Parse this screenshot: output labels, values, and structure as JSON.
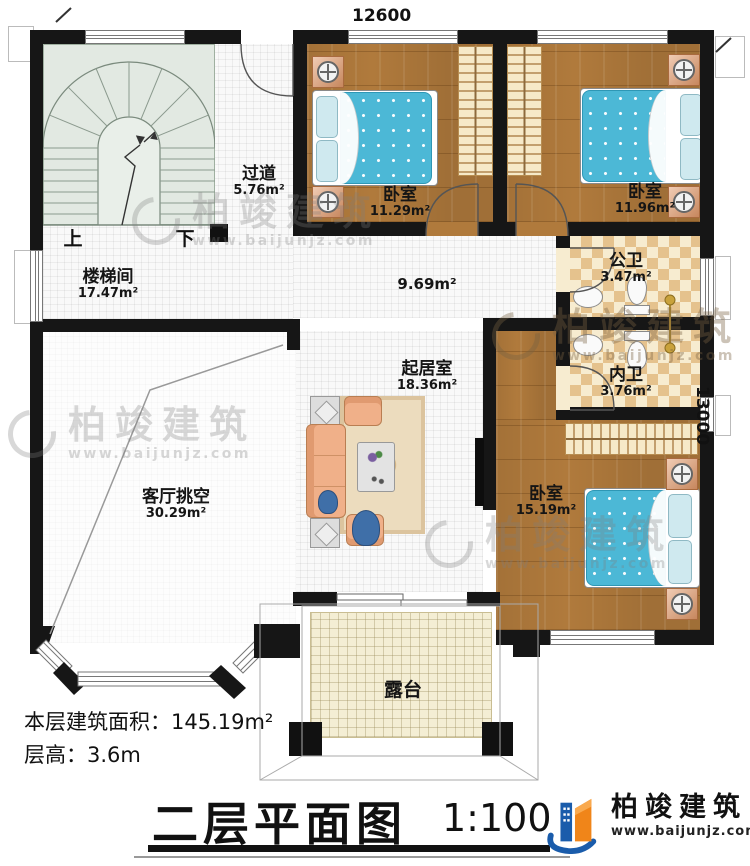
{
  "dimensions": {
    "top": "12600",
    "right": "13000"
  },
  "rooms": {
    "corridor_top": {
      "name": "过道",
      "area": "5.76m²"
    },
    "bedroom1": {
      "name": "卧室",
      "area": "11.29m²"
    },
    "bedroom2": {
      "name": "卧室",
      "area": "11.96m²"
    },
    "stairwell": {
      "name": "楼梯间",
      "area": "17.47m²"
    },
    "hall_area": {
      "area": "9.69m²"
    },
    "public_bath": {
      "name": "公卫",
      "area": "3.47m²"
    },
    "private_bath": {
      "name": "内卫",
      "area": "3.76m²"
    },
    "living": {
      "name": "起居室",
      "area": "18.36m²"
    },
    "void": {
      "name": "客厅挑空",
      "area": "30.29m²"
    },
    "bedroom3": {
      "name": "卧室",
      "area": "15.19m²"
    },
    "terrace": {
      "name": "露台"
    }
  },
  "stairs": {
    "up": "上",
    "down": "下"
  },
  "notes": {
    "area_label": "本层建筑面积：",
    "area_value": "145.19m²",
    "height_label": "层高：",
    "height_value": "3.6m"
  },
  "title": {
    "text": "二层平面图",
    "scale": "1:100"
  },
  "brand": {
    "name": "柏竣建筑",
    "url": "www.baijunjz.com"
  },
  "watermark": {
    "name": "柏竣建筑",
    "url": "www.baijunjz.com"
  }
}
